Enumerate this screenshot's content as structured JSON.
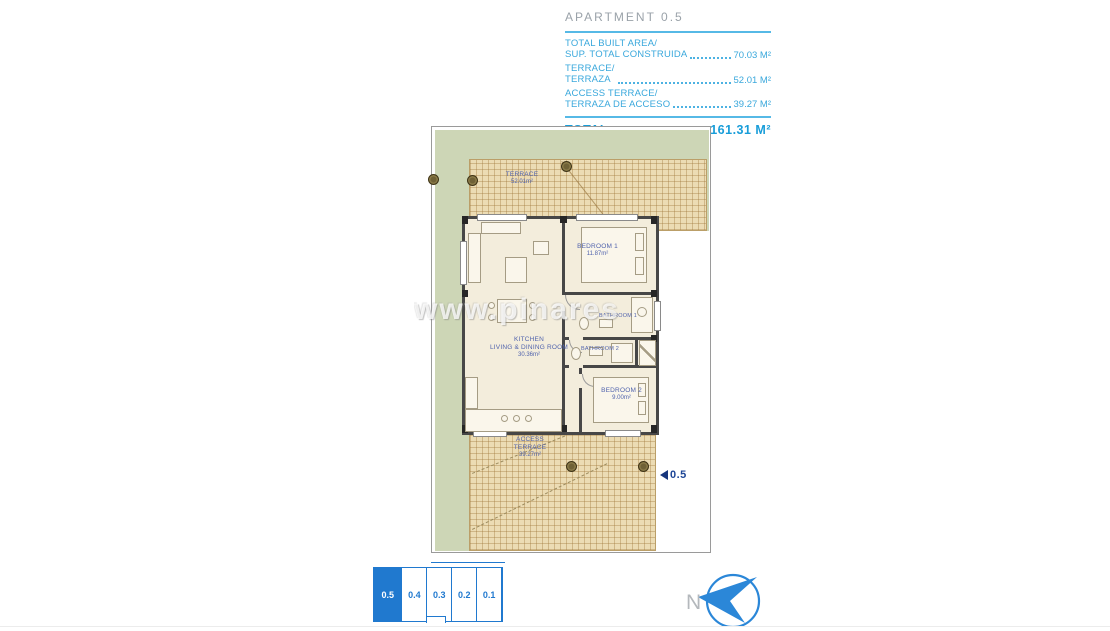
{
  "header": {
    "title": "APARTMENT 0.5",
    "rows": [
      {
        "line1": "TOTAL BUILT AREA/",
        "line2": "SUP. TOTAL CONSTRUIDA",
        "value": "70.03 M²"
      },
      {
        "line1": "TERRACE/",
        "line2": "TERRAZA",
        "value": "52.01 M²"
      },
      {
        "line1": "ACCESS TERRACE/",
        "line2": "TERRAZA DE ACCESO",
        "value": "39.27 M²"
      }
    ],
    "total": {
      "label": "TOTAL",
      "value": "161.31 M²"
    }
  },
  "plan": {
    "rooms": {
      "terrace": {
        "name": "TERRACE",
        "area": "52.01m²"
      },
      "bedroom1": {
        "name": "BEDROOM 1",
        "area": "11.87m²"
      },
      "kitchen": {
        "name": "KITCHEN",
        "name2": "LIVING & DINING ROOM",
        "area": "30.36m²"
      },
      "bathroom1": {
        "name": "BATHROOM 1"
      },
      "bathroom2": {
        "name": "BATHROOM 2"
      },
      "bedroom2": {
        "name": "BEDROOM 2",
        "area": "9.00m²"
      },
      "access_terrace": {
        "name": "ACCESS",
        "name2": "TERRACE",
        "area": "39.27m²"
      }
    },
    "unit_marker": "0.5"
  },
  "keyplan": {
    "units": [
      {
        "label": "0.5",
        "active": true
      },
      {
        "label": "0.4",
        "active": false
      },
      {
        "label": "0.3",
        "active": false
      },
      {
        "label": "0.2",
        "active": false
      },
      {
        "label": "0.1",
        "active": false
      }
    ]
  },
  "compass": {
    "label": "N"
  },
  "watermark": "www.pinares",
  "colors": {
    "header_blue": "#3aa8dc",
    "total_blue": "#189dd9",
    "title_gray": "#9aa2a9",
    "plan_label_blue": "#5063ad",
    "keyplan_blue": "#2079cf",
    "marker_navy": "#17367d",
    "tile_tan": "#ecdcb4",
    "garden_green": "#cdd6b6",
    "floor_cream": "#f3eddc",
    "wall_gray": "#474747",
    "compass_blue": "#2b87d8"
  }
}
